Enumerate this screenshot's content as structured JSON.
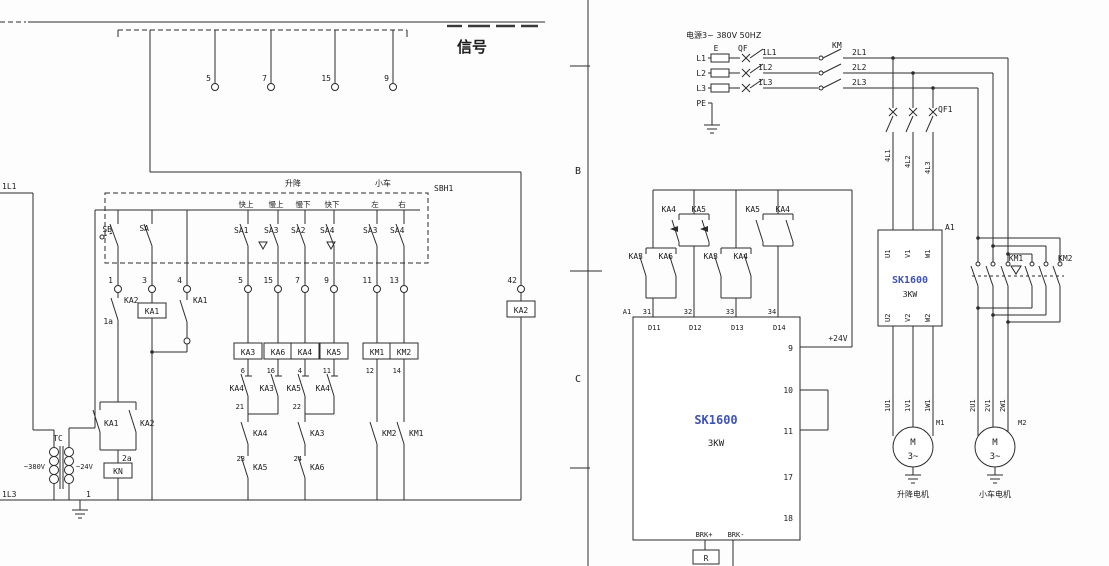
{
  "left": {
    "bus_l1": "1L1",
    "bus_l3": "1L3",
    "rail_wire": "1",
    "signal": "信号",
    "top_terminals": [
      "5",
      "7",
      "15",
      "9"
    ],
    "panel": {
      "ref": "SBH1",
      "group_hoist": "升降",
      "group_trolley": "小车",
      "columns": [
        "快上",
        "慢上",
        "慢下",
        "快下",
        "左",
        "右"
      ],
      "sb": "SB",
      "sa": "SA",
      "switches": [
        "SA1",
        "SA3",
        "SA2",
        "SA4",
        "SA3",
        "SA4"
      ]
    },
    "terminals": [
      "1",
      "3",
      "4",
      "5",
      "15",
      "7",
      "9",
      "11",
      "13"
    ],
    "terminal_42": "42",
    "ka2_contact": "KA2",
    "wire_1a": "1a",
    "ka1_coil": "KA1",
    "ka1_contact": "KA1",
    "coils": [
      "KA3",
      "KA6",
      "KA4",
      "KA5",
      "KM1",
      "KM2"
    ],
    "coil_wires": [
      "6",
      "16",
      "4",
      "11",
      "12",
      "14"
    ],
    "interlocks": [
      "KA4",
      "KA3",
      "KA5",
      "KA4"
    ],
    "junction_21": "21",
    "junction_22": "22",
    "wire_23": "23",
    "wire_24": "24",
    "series_a": [
      "KA4",
      "KA5"
    ],
    "series_b": [
      "KA3",
      "KA6"
    ],
    "km_interlock_a": "KM2",
    "km_interlock_b": "KM1",
    "ka2_coil": "KA2",
    "hold_contacts": [
      "KA1",
      "KA2"
    ],
    "wire_2a": "2a",
    "kn_coil": "KN",
    "tc": "TC",
    "v380": "~380V",
    "v24": "~24V"
  },
  "right": {
    "zone_b": "B",
    "zone_c": "C",
    "supply_title": "电源3~ 380V 50HZ",
    "phases": [
      "L1",
      "L2",
      "L3",
      "PE"
    ],
    "e_label": "E",
    "qf": "QF",
    "wires_1l": [
      "1L1",
      "1L2",
      "1L3"
    ],
    "km": "KM",
    "wires_2l": [
      "2L1",
      "2L2",
      "2L3"
    ],
    "qf1": "QF1",
    "wires_4l": [
      "4L1",
      "4L2",
      "4L3"
    ],
    "drive": {
      "ref": "A1",
      "model": "SK1600",
      "power": "3KW",
      "in_pins": [
        "U1",
        "V1",
        "W1"
      ],
      "out_pins": [
        "U2",
        "V2",
        "W2"
      ]
    },
    "motor1": {
      "wires": [
        "1U1",
        "1V1",
        "1W1"
      ],
      "ref": "M1",
      "m": "M",
      "ph": "3~",
      "caption": "升降电机"
    },
    "motor2": {
      "wires": [
        "2U1",
        "2V1",
        "2W1"
      ],
      "ref": "M2",
      "m": "M",
      "ph": "3~",
      "caption": "小车电机"
    },
    "km1": "KM1",
    "km2": "KM2",
    "ctrl": {
      "ref_a1": "A1",
      "model": "SK1600",
      "power": "3KW",
      "terms": [
        "31",
        "32",
        "33",
        "34"
      ],
      "pins_top": [
        "D11",
        "D12",
        "D13",
        "D14"
      ],
      "pin9": "9",
      "pin10": "10",
      "pin11": "11",
      "pin17": "17",
      "pin18": "18",
      "brk_p": "BRK+",
      "brk_m": "BRK-",
      "r": "R",
      "v24": "+24V",
      "c31": [
        "KA3",
        "KA6"
      ],
      "c32": [
        "KA4",
        "KA5"
      ],
      "c33": [
        "KA3",
        "KA4"
      ],
      "c34": [
        "KA5",
        "KA4"
      ]
    }
  }
}
